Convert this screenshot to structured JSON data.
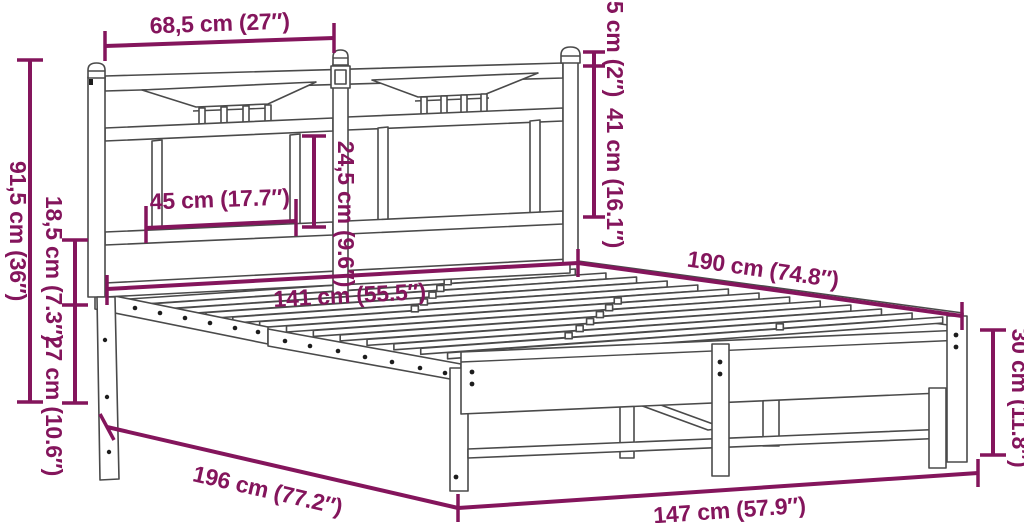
{
  "figure": {
    "title": "Bed frame dimension diagram",
    "accent_color": "#84155c",
    "line_color": "#4a4a4a",
    "background_color": "#ffffff"
  },
  "dimensions": {
    "headboard_inner_width": {
      "label": "68,5 cm (27″)"
    },
    "post_cap_height": {
      "label": "5 cm (2″)"
    },
    "headboard_upper_height": {
      "label": "41 cm (16.1″)"
    },
    "headboard_total_height": {
      "label": "91,5 cm (36″)"
    },
    "headboard_mid_height": {
      "label": "18,5 cm (7.3″)"
    },
    "frame_height": {
      "label": "27 cm (10.6″)"
    },
    "panel_opening_width": {
      "label": "45 cm (17.7″)"
    },
    "panel_opening_height": {
      "label": "24,5 cm (9.6″)"
    },
    "bed_width_inner": {
      "label": "141 cm (55.5″)"
    },
    "bed_length_inner": {
      "label": "190 cm (74.8″)"
    },
    "side_rail_height": {
      "label": "30 cm (11.8″)"
    },
    "bed_length_outer": {
      "label": "196 cm (77.2″)"
    },
    "bed_width_outer": {
      "label": "147 cm (57.9″)"
    }
  }
}
